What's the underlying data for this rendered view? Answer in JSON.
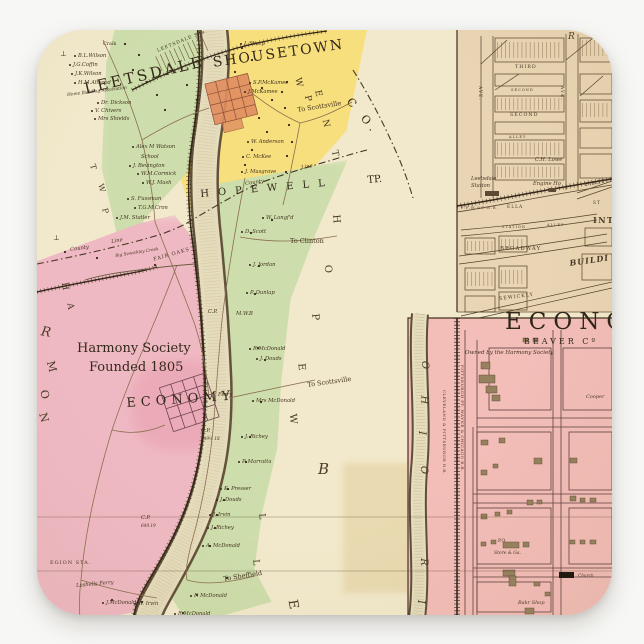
{
  "sticker": {
    "description": "vintage county atlas map sticker",
    "colors": {
      "cream": "#f2e9cc",
      "yellow": "#f7df7d",
      "green": "#cdddab",
      "pink": "#efb9c3",
      "panel_tan": "#e9d5b3",
      "panel_pink": "#f3bdb8",
      "river": "#e5dcbc",
      "ink": "#43331f",
      "shousetown_orange": "#df8d5f"
    },
    "main_map": {
      "display": {
        "leetsdale": "LEETSDALE",
        "shousetown": "SHOUSETOWN",
        "economy": "ECONOMY",
        "harmony1": "Harmony Society",
        "harmony2": "Founded 1805",
        "hopewell": "HOPEWELL",
        "tp": "TP.",
        "co": "C O.",
        "sta": "LEETSDALE STa."
      },
      "labels": [
        "Craik",
        "B.L.Wilson",
        "J.G.Coffin",
        "J.K.Wilson",
        "H.M.Atwood",
        "Home Building Association",
        "Dr. Dickson",
        "V. Chivers",
        "Mrs Shields",
        "Alex M Watson",
        "School",
        "J. Bevington",
        "W.M.Cormick",
        "W.J. Mash",
        "S. Fussman",
        "T.G.M.Cron",
        "J.M. Statler",
        "County",
        "Line",
        "Big Sewickley Creek",
        "FAIR OAKS",
        "J. Sharp",
        "S.P.McKamee",
        "J.McKamee",
        "To Scottsville",
        "W. Anderson",
        "C. McKee",
        "J. Musgrave",
        "Line",
        "County",
        "W. Langf'd",
        "D. Scott",
        "To Clinton",
        "J. Jordan",
        "P. Dunlap",
        "C.P.",
        "M.W.B",
        "R.McDonald",
        "J. Douds",
        "To Scottsville",
        "Ferry",
        "Mrs McDonald",
        "C.P.",
        "649½ 18",
        "J. Richey",
        "P. Marratta",
        "K. Presser",
        "J. Douds",
        "J. Irvin",
        "J. Richey",
        "A. McDonald",
        "C.P.",
        "649.19",
        "EGION STA.",
        "Lashells Ferry",
        "To Sheffield",
        "J.McDonald",
        "W. Irvin",
        "F. McDonald",
        "R.McDonald"
      ],
      "letters": [
        "W",
        "P",
        "E",
        "N",
        "T",
        "H",
        "O",
        "P",
        "E",
        "W",
        "B",
        "L",
        "L",
        "E",
        "T",
        "W",
        "P",
        "H",
        "A",
        "R",
        "M",
        "O",
        "N",
        "R",
        "⊥",
        "⊥"
      ]
    },
    "leetsdale_plan": {
      "labels": [
        "THIRD",
        "SECOND",
        "SECOND",
        "ALLEY",
        "C.H. Lowe",
        "FIRST",
        "Leetsdale",
        "Station",
        "Engine Ho",
        "P.F.W.&C.R.R.",
        "ELLA",
        "ST",
        "STATION",
        "ALLEY",
        "BROADWAY",
        "INTE",
        "BUILDI",
        "SEWICKLY",
        "AVE.",
        "AVE."
      ]
    },
    "economy_plan": {
      "title": "ECONOMY",
      "subtitle": "BEAVER Cº",
      "credit": "Owned by the Harmony Society",
      "labels": [
        "Cooper",
        "P.O.",
        "Store & Ga.",
        "Bakr Shop",
        "Church"
      ],
      "river_letters": [
        "O",
        "H",
        "I",
        "O",
        "R",
        "I"
      ],
      "railroads": [
        "CLEVELAND & PITTSBURGH R.R.",
        "PITTSBURGH FT. WAYNE & CHICAGO R.R."
      ]
    }
  }
}
